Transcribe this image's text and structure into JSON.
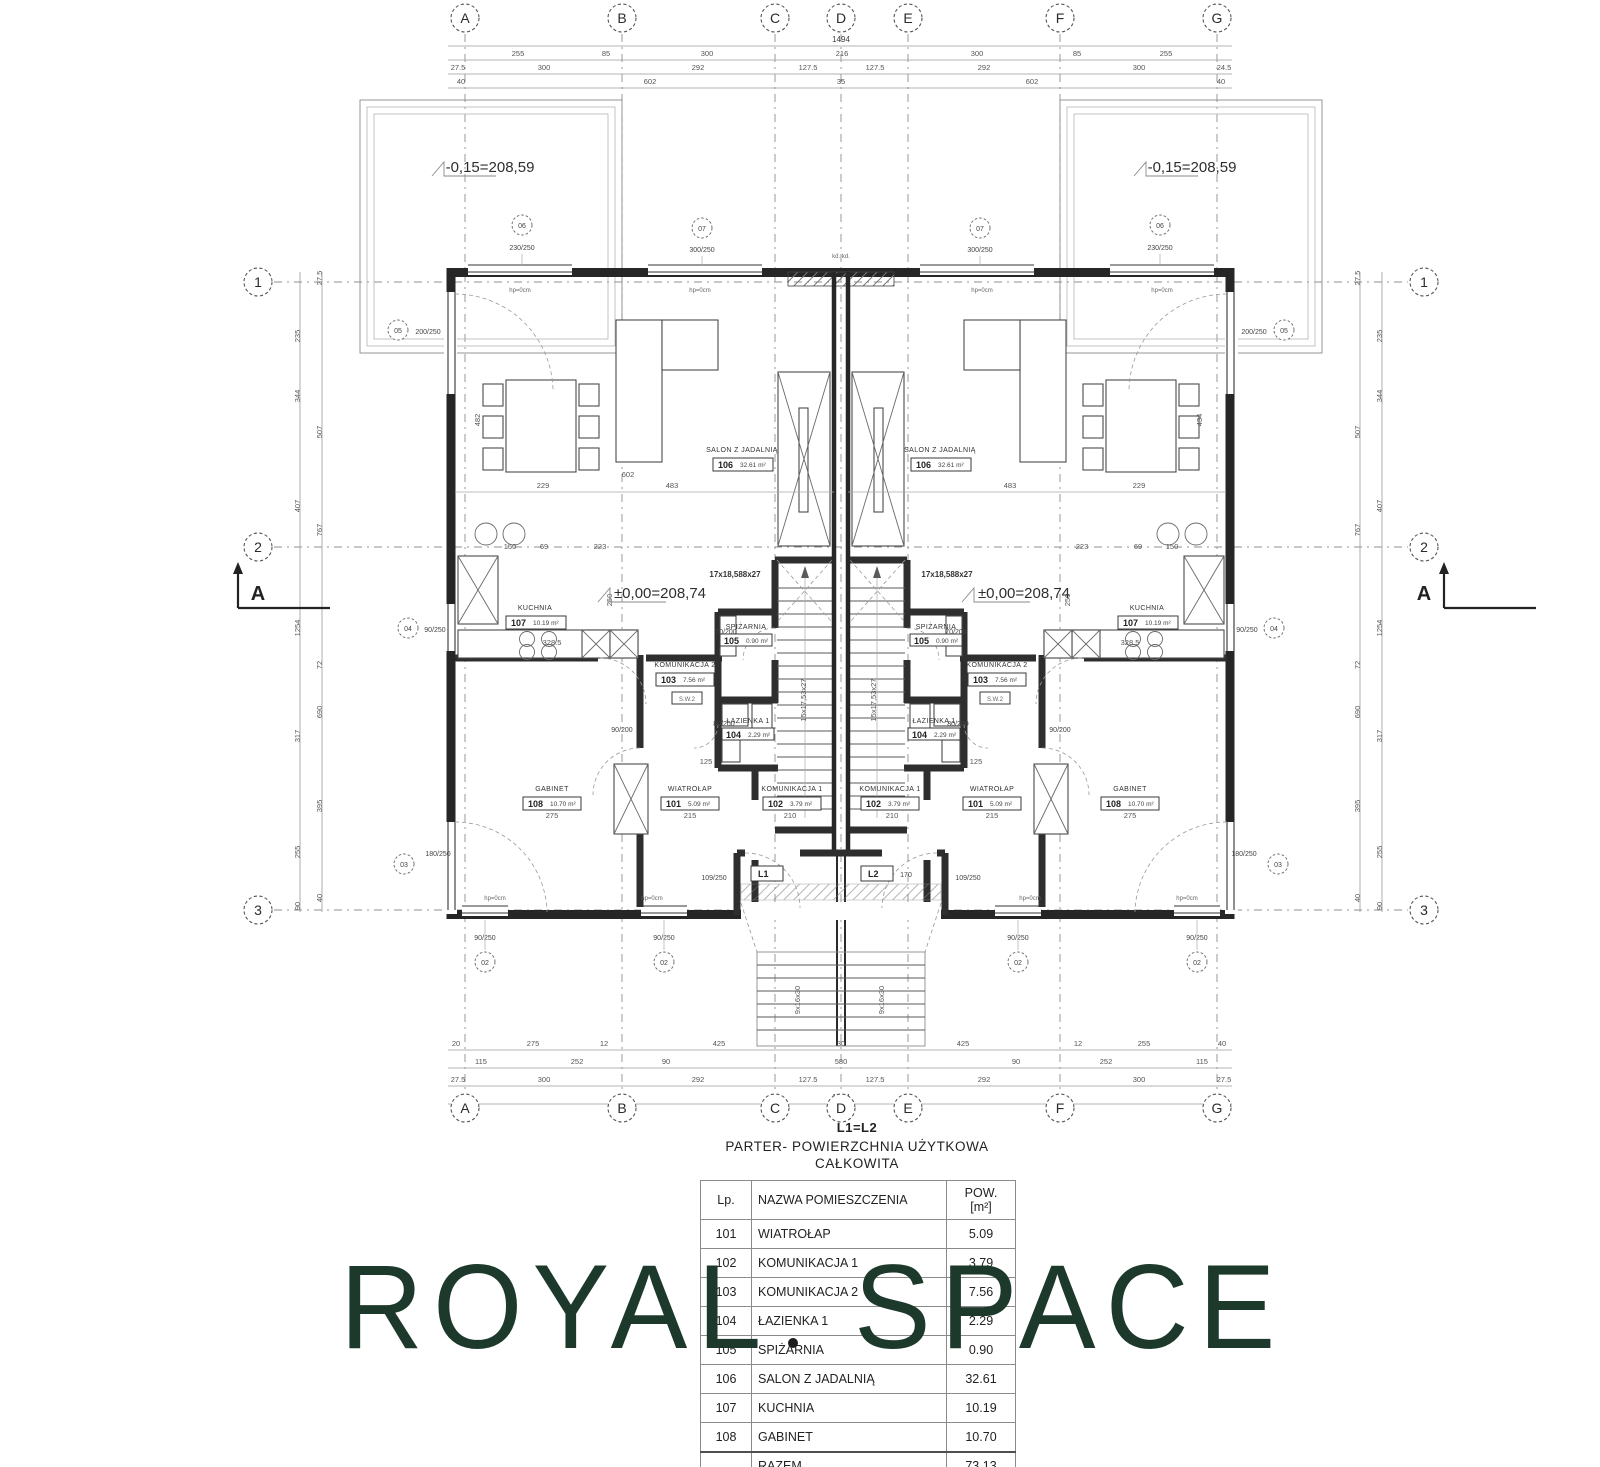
{
  "logo": {
    "text": "ROYAL SPACE",
    "color": "#1d392c"
  },
  "schedule": {
    "subtitle": "L1=L2",
    "title_line1": "PARTER- POWIERZCHNIA UŻYTKOWA",
    "title_line2": "CAŁKOWITA",
    "col_lp": "Lp.",
    "col_name": "NAZWA POMIESZCZENIA",
    "col_pow1": "POW.",
    "col_pow2": "[m²]",
    "rows": [
      {
        "lp": "101",
        "name": "WIATROŁAP",
        "pow": "5.09"
      },
      {
        "lp": "102",
        "name": "KOMUNIKACJA 1",
        "pow": "3.79"
      },
      {
        "lp": "103",
        "name": "KOMUNIKACJA 2",
        "pow": "7.56"
      },
      {
        "lp": "104",
        "name": "ŁAZIENKA 1",
        "pow": "2.29"
      },
      {
        "lp": "105",
        "name": "SPIŻARNIA",
        "pow": "0.90"
      },
      {
        "lp": "106",
        "name": "SALON Z JADALNIĄ",
        "pow": "32.61"
      },
      {
        "lp": "107",
        "name": "KUCHNIA",
        "pow": "10.19"
      },
      {
        "lp": "108",
        "name": "GABINET",
        "pow": "10.70"
      }
    ],
    "total_label": "RAZEM",
    "total": "73.13"
  },
  "plan": {
    "grid_letters": [
      "A",
      "B",
      "C",
      "D",
      "E",
      "F",
      "G"
    ],
    "grid_numbers": [
      "1",
      "2",
      "3"
    ],
    "section_label": "A",
    "elev_terrace": "-0,15=208,59",
    "elev_floor": "±0,00=208,74",
    "stair_run": "17x18,588x27",
    "stair_flight": "15x17,53x27",
    "ext_stair": "9x16x30",
    "kd": "kd. kd.",
    "hp": "hp=0cm",
    "sw": "S.W.2",
    "rooms": {
      "salon": {
        "no": "106",
        "name": "SALON Z JADALNIĄ",
        "area": "32.61 m²"
      },
      "kuchnia": {
        "no": "107",
        "name": "KUCHNIA",
        "area": "10.19 m²"
      },
      "kom2": {
        "no": "103",
        "name": "KOMUNIKACJA 2",
        "area": "7.56 m²"
      },
      "spiz": {
        "no": "105",
        "name": "SPIŻARNIA",
        "area": "0.90 m²"
      },
      "laz": {
        "no": "104",
        "name": "ŁAZIENKA 1",
        "area": "2.29 m²"
      },
      "wiat": {
        "no": "101",
        "name": "WIATROŁAP",
        "area": "5.09 m²"
      },
      "kom1": {
        "no": "102",
        "name": "KOMUNIKACJA 1",
        "area": "3.79 m²"
      },
      "gabinet": {
        "no": "108",
        "name": "GABINET",
        "area": "10.70 m²"
      }
    },
    "tags": {
      "t06": {
        "no": "06",
        "size": "230/250"
      },
      "t07": {
        "no": "07",
        "size": "300/250"
      },
      "t05": {
        "no": "05",
        "size": "200/250"
      },
      "t04": {
        "no": "04",
        "size": "90/250"
      },
      "t03": {
        "no": "03",
        "size": "180/250"
      },
      "t02": {
        "no": "02",
        "size": "90/250"
      },
      "d109": "109/250",
      "l1": "L1",
      "l2": "L2",
      "l2w": "170"
    },
    "doors": {
      "d70": "70/200",
      "d80": "80/200",
      "d90": "90/200"
    },
    "dims": {
      "top_total": "1494",
      "top1": [
        "255",
        "85",
        "300",
        "216",
        "300",
        "85",
        "255"
      ],
      "top2": [
        "27.5",
        "300",
        "292",
        "127.5",
        "127.5",
        "292",
        "300",
        "24.5"
      ],
      "top3": [
        "40",
        "602",
        "35",
        "602",
        "40"
      ],
      "bot1": [
        "20",
        "275",
        "12",
        "425",
        "30",
        "425",
        "12",
        "255",
        "40"
      ],
      "bot2": [
        "115",
        "252",
        "90",
        "580",
        "90",
        "252",
        "115"
      ],
      "bot3": [
        "27.5",
        "300",
        "292",
        "127.5",
        "127.5",
        "292",
        "300",
        "27.5"
      ],
      "bot_total": "1494",
      "left": [
        "235",
        "344",
        "407",
        "1254",
        "317",
        "255",
        "90",
        "27.5",
        "507",
        "767",
        "72",
        "690",
        "395",
        "40"
      ],
      "d229": "229",
      "d483": "483",
      "d602": "602",
      "d328": "328.5",
      "d250": "250",
      "d482": "482",
      "d434": "434",
      "d150": "150",
      "d69": "69",
      "d223": "223",
      "d215": "215",
      "d210": "210",
      "d275": "275",
      "d125": "125"
    }
  }
}
